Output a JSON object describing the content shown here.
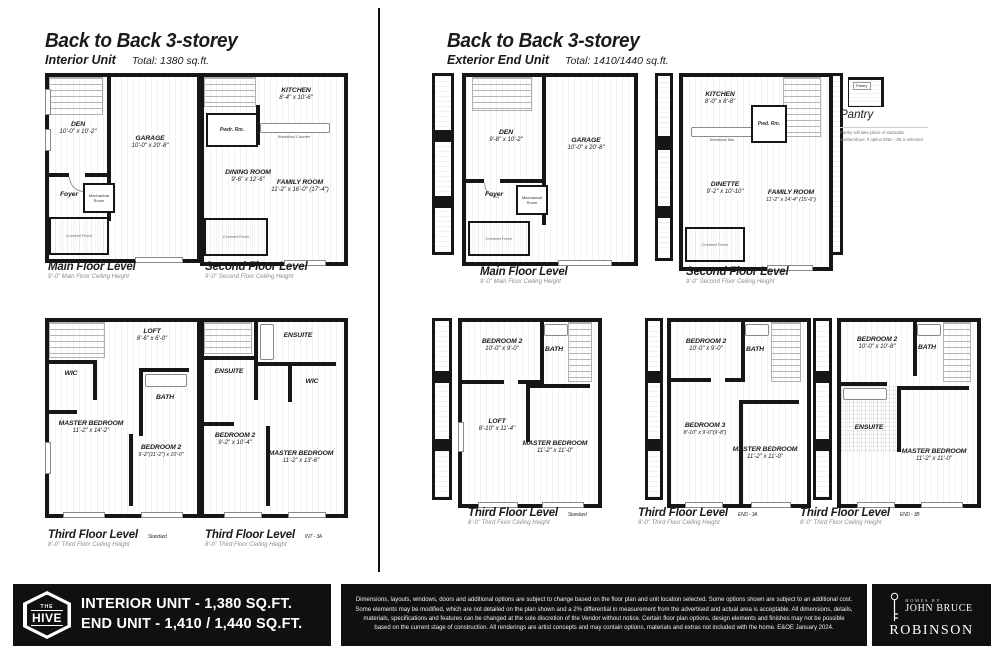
{
  "left": {
    "title": "Back to Back 3-storey",
    "subtitle": "Interior Unit",
    "total": "Total: 1380 sq.ft.",
    "main_floor": {
      "den": "DEN",
      "den_dim": "10'-0\" x 10'-2\"",
      "garage": "GARAGE",
      "garage_dim": "10'-0\" x 20'-8\"",
      "foyer": "Foyer",
      "mech": "Mechanical Room",
      "porch": "Covered Porch",
      "label": "Main Floor Level",
      "ceiling": "9'-0\" Main Floor Ceiling Height"
    },
    "second_floor": {
      "kitchen": "KITCHEN",
      "kitchen_dim": "8'-4\" x 10'-6\"",
      "pwdr": "Pwdr. Rm.",
      "dining": "DINING ROOM",
      "dining_dim": "9'-6\" x 12'-6\"",
      "family": "FAMILY ROOM",
      "family_dim": "11'-2\" x 16'-0\" (17'-4\")",
      "breakfast": "Breakfast Counter",
      "porch": "Covered Porch",
      "label": "Second Floor Level",
      "ceiling": "9'-0\" Second Floor Ceiling Height"
    },
    "third_standard": {
      "loft": "LOFT",
      "loft_dim": "8'-6\" x 6'-0\"",
      "wic": "WIC",
      "bath": "BATH",
      "master": "MASTER BEDROOM",
      "master_dim": "11'-2\" x 14'-2\"",
      "bed2": "BEDROOM 2",
      "bed2_dim": "9'-2\"(11'-2\") x 10'-0\"",
      "label": "Third Floor Level",
      "variant": "Standard",
      "ceiling": "8'-0\" Third Floor Ceiling Height"
    },
    "third_alt": {
      "ensuite1": "ENSUITE",
      "ensuite2": "ENSUITE",
      "wic": "WIC",
      "bed2": "BEDROOM 2",
      "bed2_dim": "9'-2\" x 10'-4\"",
      "master": "MASTER BEDROOM",
      "master_dim": "11'-2\" x 13'-6\"",
      "label": "Third Floor Level",
      "variant": "INT - 3A",
      "ceiling": "8'-0\" Third Floor Ceiling Height"
    }
  },
  "right": {
    "title": "Back to Back 3-storey",
    "subtitle": "Exterior End Unit",
    "total": "Total: 1410/1440 sq.ft.",
    "main_floor": {
      "den": "DEN",
      "den_dim": "9'-8\" x 10'-2\"",
      "garage": "GARAGE",
      "garage_dim": "10'-0\" x 20'-8\"",
      "foyer": "Foyer",
      "mech": "Mechanical Room",
      "porch": "Covered Porch",
      "label": "Main Floor Level",
      "ceiling": "9'-0\" Main Floor Ceiling Height"
    },
    "second_floor": {
      "kitchen": "KITCHEN",
      "kitchen_dim": "8'-0\" x 8'-8\"",
      "pwd": "Pwd. Rm.",
      "dinette": "DINETTE",
      "dinette_dim": "9'-2\" x 10'-10\"",
      "family": "FAMILY ROOM",
      "family_dim": "11'-2\" x 14'-4\" (15'-6\")",
      "breakfast": "Breakfast Bar",
      "porch": "Covered Porch",
      "label": "Second Floor Level",
      "ceiling": "9'-0\" Second Floor Ceiling Height"
    },
    "pantry": {
      "tag": "Pantry",
      "heading": "Pantry",
      "note": "Pantry will take place of stackable washer/dryer, if option END - 3B is selected"
    },
    "third_standard": {
      "bed2": "BEDROOM 2",
      "bed2_dim": "10'-0\" x 9'-0\"",
      "bath": "BATH",
      "loft": "LOFT",
      "loft_dim": "8'-10\" x 11'-4\"",
      "master": "MASTER BEDROOM",
      "master_dim": "11'-2\" x 11'-0\"",
      "label": "Third Floor Level",
      "variant": "Standard",
      "ceiling": "8'-0\" Third Floor Ceiling Height"
    },
    "third_end3a": {
      "bed2": "BEDROOM 2",
      "bed2_dim": "10'-0\" x 9'-0\"",
      "bath": "BATH",
      "bed3": "BEDROOM 3",
      "bed3_dim": "8'-10\" x 9'-0\"(9'-8\")",
      "master": "MASTER BEDROOM",
      "master_dim": "11'-2\" x 11'-0\"",
      "label": "Third Floor Level",
      "variant": "END - 3A",
      "ceiling": "8'-0\" Third Floor Ceiling Height"
    },
    "third_end3b": {
      "bed2": "BEDROOM 2",
      "bed2_dim": "10'-0\" x 10'-8\"",
      "bath": "BATH",
      "ensuite": "ENSUITE",
      "master": "MASTER BEDROOM",
      "master_dim": "11'-2\" x 11'-0\"",
      "label": "Third Floor Level",
      "variant": "END - 3B",
      "ceiling": "8'-0\" Third Floor Ceiling Height"
    }
  },
  "footer": {
    "hive_the": "THE",
    "hive_name": "HIVE",
    "line1": "INTERIOR UNIT - 1,380 SQ.FT.",
    "line2": "END UNIT - 1,410 / 1,440 SQ.FT.",
    "disclaimer": "Dimensions, layouts, windows, doors and additional options are subject to change based on the floor plan and unit location selected. Some options shown are subject to an additional cost. Some elements may be modified, which are not detailed on the plan shown and a 2% differential in measurement from the advertised and actual area is acceptable. All dimensions, details, materials, specifications and features can be changed at the sole discretion of the Vendor without notice. Certain floor plan options, design elements and finishes may not be possible based on the current stage of construction.  All renderings are artist concepts and may contain options, materials and extras not included with the home. E&OE January 2024.",
    "brand_top": "HOMES BY",
    "brand_name": "JOHN BRUCE",
    "brand_name2": "ROBINSON"
  }
}
